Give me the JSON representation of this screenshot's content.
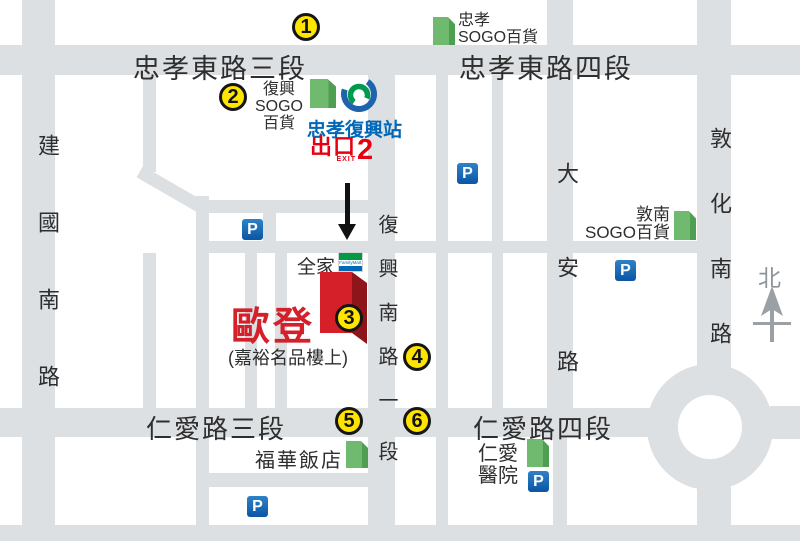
{
  "map": {
    "roads": {
      "zhongxiao_e_3": "忠孝東路三段",
      "zhongxiao_e_4": "忠孝東路四段",
      "renai_3": "仁愛路三段",
      "renai_4": "仁愛路四段",
      "jianguo_s": "建國南路",
      "dunhua_s": "敦化南路",
      "daan": "大安路",
      "fuxing_s_main": "復興南路一",
      "fuxing_s_tail": "段"
    },
    "landmarks": {
      "zhongxiao_sogo_line1": "忠孝",
      "zhongxiao_sogo_line2": "SOGO百貨",
      "fuxing_sogo_line1": "復興",
      "fuxing_sogo_line2": "SOGO",
      "fuxing_sogo_line3": "百貨",
      "dunnan_sogo_line1": "敦南",
      "dunnan_sogo_line2": "SOGO百貨",
      "howard_hotel": "福華飯店",
      "renai_hospital_line1": "仁愛",
      "renai_hospital_line2": "醫院",
      "familymart": "全家",
      "familymart_logo": "FamilyMart",
      "ouden": "歐登",
      "ouden_note": "(嘉裕名品樓上)"
    },
    "station": {
      "name": "忠孝復興站",
      "exit_label": "出口",
      "exit_sub": "EXIT",
      "exit_number": "2"
    },
    "markers": [
      "1",
      "2",
      "3",
      "4",
      "5",
      "6"
    ],
    "parking_label": "P",
    "compass_north": "北",
    "colors": {
      "road_gray": "#dce0e3",
      "marker_yellow": "#ffe400",
      "station_blue": "#0068b7",
      "exit_red": "#e60012",
      "ouden_red": "#d5202a",
      "building_green": "#6fba6e",
      "parking_blue": "#0b55a4"
    }
  }
}
